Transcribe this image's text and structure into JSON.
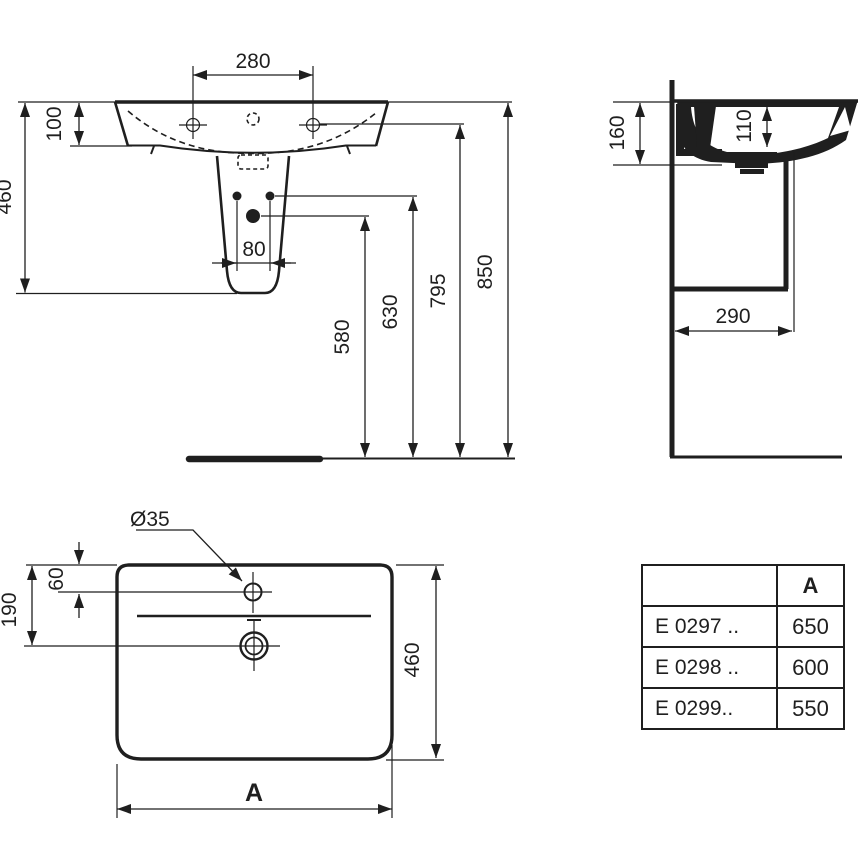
{
  "colors": {
    "ink": "#1f1f1f",
    "paper": "#ffffff"
  },
  "front_view": {
    "tap_hole_spacing": "280",
    "rim_to_basin_bottom": "100",
    "basin_pedestal_height": "460",
    "fixing_hole_spacing": "80",
    "height_drain": "580",
    "height_fixing_holes": "630",
    "height_tap_holes": "795",
    "height_rim": "850"
  },
  "side_view": {
    "wall_drop": "160",
    "bowl_depth": "110",
    "clearance_depth": "290"
  },
  "top_view": {
    "tap_hole_diameter": "Ø35",
    "tap_hole_offset": "60",
    "drain_offset": "190",
    "overall_depth": "460",
    "overall_width": "A"
  },
  "spec_table": {
    "width_column_header": "A",
    "rows": [
      {
        "model": "E 0297 ..",
        "width": "650"
      },
      {
        "model": "E 0298 ..",
        "width": "600"
      },
      {
        "model": "E 0299..",
        "width": "550"
      }
    ]
  }
}
